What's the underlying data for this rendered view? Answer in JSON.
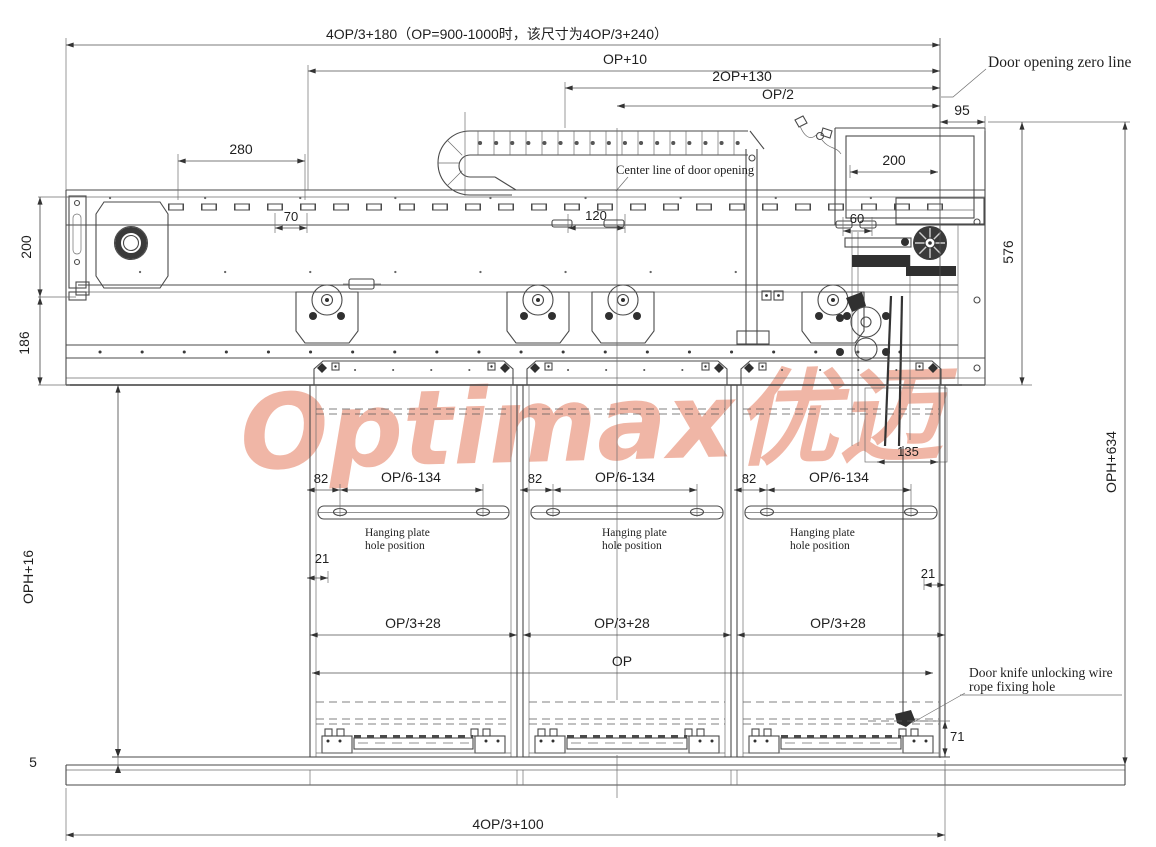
{
  "drawing": {
    "watermark": "Optimax优迈",
    "watermark_color": "#eb9b84",
    "line_color": "#4a4a4a"
  },
  "dims": {
    "top_formula": "4OP/3+180（OP=900-1000时，该尺寸为4OP/3+240）",
    "op_plus_10": "OP+10",
    "two_op_130": "2OP+130",
    "op_half": "OP/2",
    "d95": "95",
    "d280": "280",
    "d70": "70",
    "d120": "120",
    "d60": "60",
    "d200_motor": "200",
    "d200_left": "200",
    "d186": "186",
    "d576": "576",
    "oph_634": "OPH+634",
    "oph_16": "OPH+16",
    "d5": "5",
    "d135": "135",
    "d21_left": "21",
    "d21_right": "21",
    "op": "OP",
    "d71": "71",
    "bottom_formula": "4OP/3+100"
  },
  "annotations": {
    "door_zero": "Door opening zero line",
    "center_line": "Center line of door opening",
    "door_knife_1": "Door knife unlocking wire",
    "door_knife_2": "rope fixing hole"
  },
  "panels": [
    {
      "d82": "82",
      "hole_dim": "OP/6-134",
      "label1": "Hanging plate",
      "label2": "hole position",
      "width_dim": "OP/3+28"
    },
    {
      "d82": "82",
      "hole_dim": "OP/6-134",
      "label1": "Hanging plate",
      "label2": "hole position",
      "width_dim": "OP/3+28"
    },
    {
      "d82": "82",
      "hole_dim": "OP/6-134",
      "label1": "Hanging plate",
      "label2": "hole position",
      "width_dim": "OP/3+28"
    }
  ]
}
